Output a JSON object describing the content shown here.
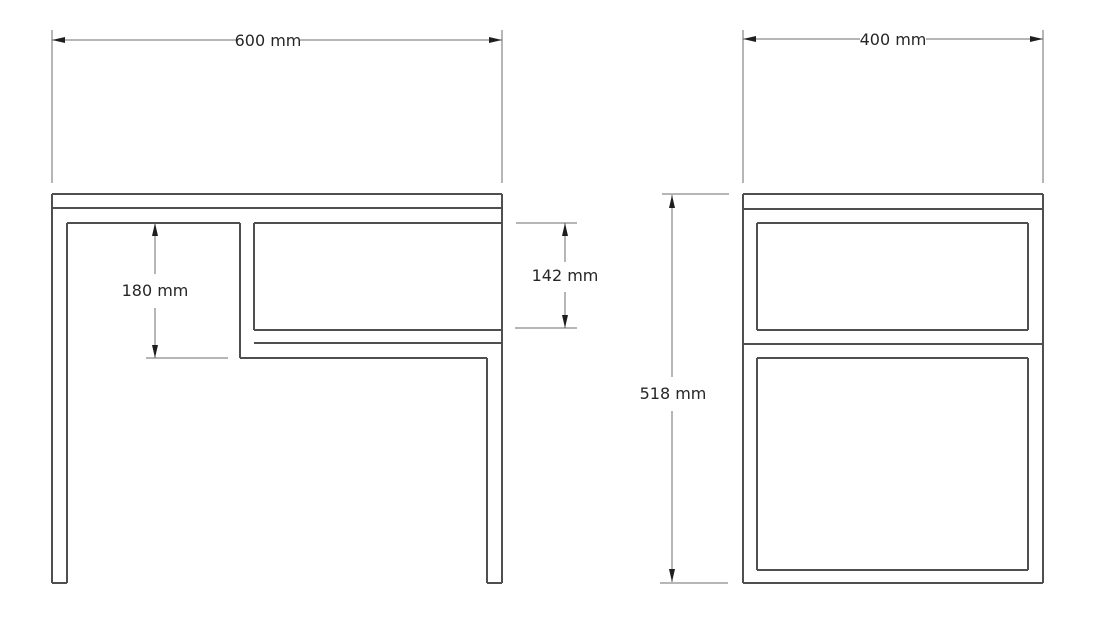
{
  "canvas": {
    "width": 1096,
    "height": 619,
    "background": "#ffffff"
  },
  "drawing": {
    "kind": "furniture technical drawing, two orthographic elevations of a side table with lower shelf compartment",
    "unit": "mm",
    "geometry_color": "#4f4f4f",
    "dimension_color": "#6e6e6e",
    "arrow_color": "#1f1f1f",
    "text_color": "#262626"
  },
  "measurements": {
    "overall_width": {
      "value": 600,
      "unit": "mm"
    },
    "overall_depth": {
      "value": 400,
      "unit": "mm"
    },
    "overall_height": {
      "value": 518,
      "unit": "mm"
    },
    "left_opening_height": {
      "value": 180,
      "unit": "mm"
    },
    "compartment_opening_height": {
      "value": 142,
      "unit": "mm"
    }
  },
  "views": [
    {
      "id": "front-view",
      "name": "front elevation",
      "lines": [
        [
          52,
          194,
          502,
          194
        ],
        [
          52,
          208,
          502,
          208
        ],
        [
          67,
          223,
          240,
          223
        ],
        [
          254,
          223,
          501,
          223
        ],
        [
          254,
          330,
          502,
          330
        ],
        [
          254,
          343,
          502,
          343
        ],
        [
          240,
          358,
          487,
          358
        ],
        [
          52,
          583,
          67,
          583
        ],
        [
          487,
          583,
          502,
          583
        ],
        [
          52,
          194,
          52,
          583
        ],
        [
          67,
          223,
          67,
          583
        ],
        [
          240,
          223,
          240,
          358
        ],
        [
          254,
          223,
          254,
          330
        ],
        [
          487,
          358,
          487,
          583
        ],
        [
          502,
          194,
          502,
          583
        ]
      ],
      "dimensions": [
        {
          "id": "overall-width",
          "label": "600 mm",
          "type": "horizontal",
          "axis": 40,
          "from": 52,
          "to": 502,
          "gap": [
            236,
            300
          ],
          "text_pos": [
            268,
            46
          ],
          "extensions": [
            [
              52,
              30,
              52,
              183
            ],
            [
              502,
              30,
              502,
              183
            ]
          ]
        },
        {
          "id": "left-opening-height",
          "label": "180 mm",
          "type": "vertical",
          "axis": 155,
          "from": 223,
          "to": 358,
          "gap": [
            274,
            308
          ],
          "text_pos": [
            155,
            296
          ],
          "extensions": [
            [
              146,
              358,
              228,
              358
            ]
          ]
        },
        {
          "id": "compartment-opening-height",
          "label": "142 mm",
          "type": "vertical",
          "axis": 565,
          "from": 223,
          "to": 328,
          "gap": [
            262,
            292
          ],
          "text_pos": [
            565,
            281
          ],
          "extensions": [
            [
              516,
              223,
              577,
              223
            ],
            [
              515,
              328,
              577,
              328
            ]
          ]
        }
      ]
    },
    {
      "id": "side-view",
      "name": "side elevation",
      "lines": [
        [
          743,
          194,
          1043,
          194
        ],
        [
          743,
          209,
          1043,
          209
        ],
        [
          757,
          223,
          1028,
          223
        ],
        [
          757,
          330,
          1028,
          330
        ],
        [
          743,
          344,
          1043,
          344
        ],
        [
          757,
          358,
          1028,
          358
        ],
        [
          757,
          570,
          1028,
          570
        ],
        [
          743,
          583,
          1043,
          583
        ],
        [
          743,
          194,
          743,
          583
        ],
        [
          1043,
          194,
          1043,
          583
        ],
        [
          757,
          223,
          757,
          330
        ],
        [
          1028,
          223,
          1028,
          330
        ],
        [
          757,
          358,
          757,
          570
        ],
        [
          1028,
          358,
          1028,
          570
        ]
      ],
      "dimensions": [
        {
          "id": "overall-depth",
          "label": "400 mm",
          "type": "horizontal",
          "axis": 39,
          "from": 743,
          "to": 1043,
          "gap": [
            860,
            926
          ],
          "text_pos": [
            893,
            45
          ],
          "extensions": [
            [
              743,
              30,
              743,
              183
            ],
            [
              1043,
              30,
              1043,
              183
            ]
          ]
        },
        {
          "id": "overall-height",
          "label": "518 mm",
          "type": "vertical",
          "axis": 672,
          "from": 195,
          "to": 582,
          "gap": [
            377,
            411
          ],
          "text_pos": [
            673,
            399
          ],
          "extensions": [
            [
              662,
              194,
              729,
              194
            ],
            [
              660,
              583,
              728,
              583
            ]
          ]
        }
      ]
    }
  ]
}
